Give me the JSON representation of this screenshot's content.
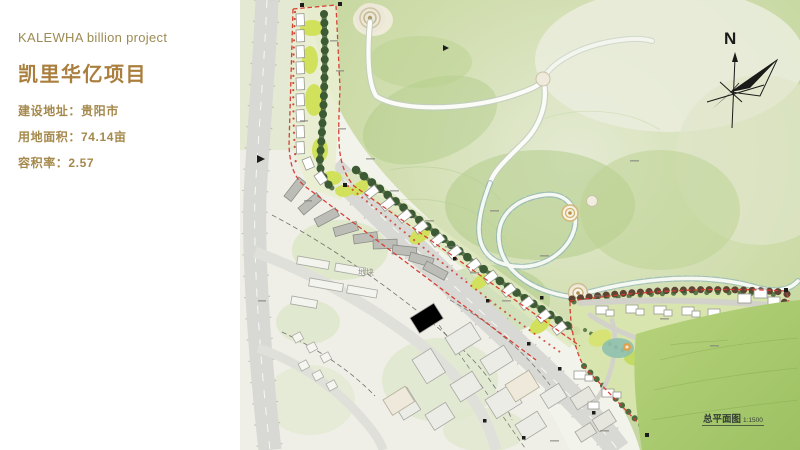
{
  "panel": {
    "title_en": "KALEWHA billion project",
    "title_zh": "凯里华亿项目",
    "address": "建设地址：贵阳市",
    "area": "用地面积：74.14亩",
    "far": "容积率：2.57"
  },
  "compass": {
    "north_label": "N"
  },
  "map": {
    "scale_label": "总平面图",
    "scale_value": "1:1500",
    "plot_label": "地块"
  },
  "colors": {
    "title_gold": "#a5894c",
    "title_brown": "#aa7f3e",
    "boundary_red": "#d6392c",
    "tree_green": "#3c5a33",
    "hill_green": "#cedcaa",
    "bright_hill_green": "#a4c768",
    "road_gray": "#d8d8d4",
    "loop_road_blue": "#8fb3b9"
  }
}
